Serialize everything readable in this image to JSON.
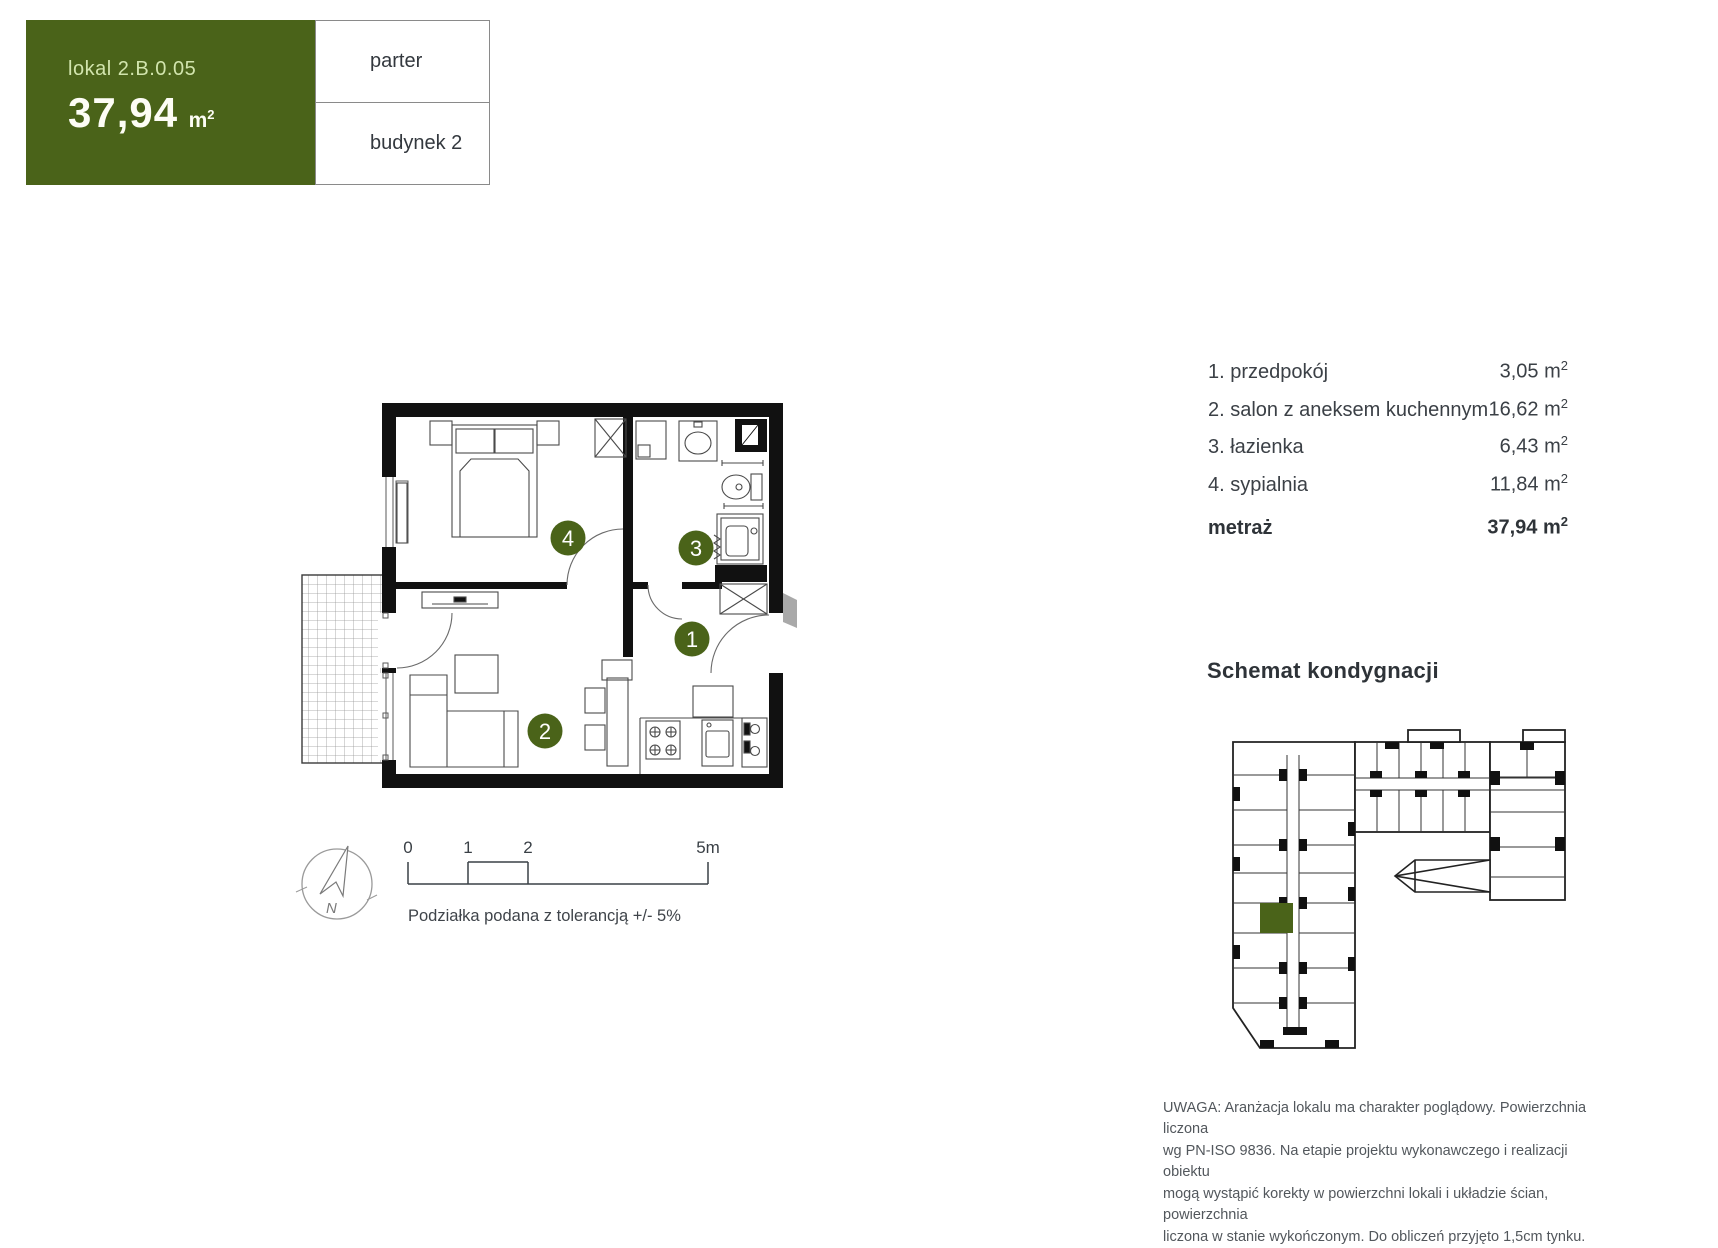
{
  "header": {
    "lokal_label": "lokal 2.B.0.05",
    "area_value": "37,94",
    "area_unit_base": "m",
    "area_unit_sup": "2",
    "floor": "parter",
    "building": "budynek 2"
  },
  "rooms": [
    {
      "label": "1. przedpokój",
      "value": "3,05",
      "unit_base": "m",
      "unit_sup": "2"
    },
    {
      "label": "2. salon z aneksem kuchennym",
      "value": "16,62",
      "unit_base": "m",
      "unit_sup": "2"
    },
    {
      "label": "3. łazienka",
      "value": "6,43",
      "unit_base": "m",
      "unit_sup": "2"
    },
    {
      "label": "4. sypialnia",
      "value": "11,84",
      "unit_base": "m",
      "unit_sup": "2"
    }
  ],
  "total": {
    "label": "metraż",
    "value": "37,94",
    "unit_base": "m",
    "unit_sup": "2"
  },
  "plan": {
    "badges": {
      "bedroom": "4",
      "bathroom": "3",
      "hallway": "1",
      "living": "2"
    }
  },
  "compass": {
    "north": "N"
  },
  "scale_bar": {
    "labels": [
      "0",
      "1",
      "2",
      "5m"
    ],
    "caption": "Podziałka podana z tolerancją +/- 5%"
  },
  "schematic": {
    "title": "Schemat kondygnacji"
  },
  "disclaimer": {
    "lines": [
      "UWAGA: Aranżacja lokalu ma charakter poglądowy. Powierzchnia liczona",
      "wg PN-ISO 9836. Na etapie projektu wykonawczego i realizacji obiektu",
      "mogą wystąpić korekty w powierzchni lokali i układzie ścian, powierzchnia",
      "liczona w stanie wykończonym. Do obliczeń przyjęto 1,5cm tynku."
    ]
  },
  "colors": {
    "accent_green": "#4a6319",
    "accent_green_light": "#d2e5ad",
    "wall_black": "#111111",
    "text_dark": "#343a40",
    "text_gray": "#52575c",
    "border_gray": "#8a8a8a"
  }
}
